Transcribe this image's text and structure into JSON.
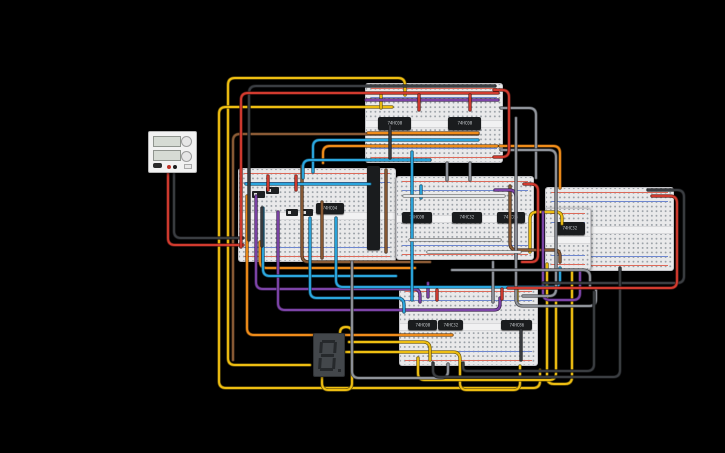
{
  "canvas": {
    "width": 725,
    "height": 453,
    "background": "#000000"
  },
  "wire_colors": {
    "yellow": "#eebe12",
    "red": "#d23b2f",
    "black": "#3a3d41",
    "gray": "#8f939a",
    "white": "#e4e6e8",
    "cyan": "#2ba6de",
    "orange": "#ef8c1a",
    "purple": "#7d44a8",
    "brown": "#8a5a35"
  },
  "power_supply": {
    "x": 148,
    "y": 131,
    "w": 49,
    "h": 42,
    "displays": 2,
    "knobs": 2,
    "terminal_colors": [
      "#c03226",
      "#1c1c1c"
    ]
  },
  "seven_segment": {
    "x": 313,
    "y": 333,
    "w": 32,
    "h": 44,
    "value": "8.",
    "body_color": "#43474b",
    "segment_color": "#26292c"
  },
  "breadboards": [
    {
      "id": "top",
      "x": 365,
      "y": 83,
      "w": 138,
      "h": 80
    },
    {
      "id": "left",
      "x": 238,
      "y": 168,
      "w": 158,
      "h": 94
    },
    {
      "id": "center",
      "x": 396,
      "y": 176,
      "w": 138,
      "h": 84
    },
    {
      "id": "right",
      "x": 545,
      "y": 187,
      "w": 129,
      "h": 84
    },
    {
      "id": "right-mini",
      "x": 545,
      "y": 208,
      "w": 46,
      "h": 62
    },
    {
      "id": "bottom",
      "x": 399,
      "y": 286,
      "w": 139,
      "h": 80
    }
  ],
  "ics": [
    {
      "label": "74HC08",
      "x": 378,
      "y": 117,
      "w": 33,
      "h": 13,
      "vertical": false
    },
    {
      "label": "74HC08",
      "x": 448,
      "y": 117,
      "w": 33,
      "h": 13,
      "vertical": false
    },
    {
      "label": "74HC04",
      "x": 316,
      "y": 203,
      "w": 28,
      "h": 11,
      "vertical": false
    },
    {
      "label": "",
      "x": 367,
      "y": 166,
      "w": 13,
      "h": 84,
      "vertical": true
    },
    {
      "label": "74HC08",
      "x": 402,
      "y": 212,
      "w": 30,
      "h": 11,
      "vertical": false
    },
    {
      "label": "74HC32",
      "x": 452,
      "y": 212,
      "w": 30,
      "h": 11,
      "vertical": false
    },
    {
      "label": "74HC86",
      "x": 497,
      "y": 212,
      "w": 28,
      "h": 11,
      "vertical": false
    },
    {
      "label": "74HC32",
      "x": 555,
      "y": 222,
      "w": 30,
      "h": 13,
      "vertical": false
    },
    {
      "label": "74HC08",
      "x": 408,
      "y": 320,
      "w": 29,
      "h": 10,
      "vertical": false
    },
    {
      "label": "74HC32",
      "x": 438,
      "y": 320,
      "w": 25,
      "h": 10,
      "vertical": false
    },
    {
      "label": "74HC86",
      "x": 501,
      "y": 320,
      "w": 31,
      "h": 10,
      "vertical": false
    }
  ],
  "components": [
    {
      "type": "slide-switch",
      "x": 252,
      "y": 191,
      "w": 13,
      "h": 7
    },
    {
      "type": "slide-switch",
      "x": 266,
      "y": 187,
      "w": 13,
      "h": 7
    },
    {
      "type": "slide-switch",
      "x": 286,
      "y": 209,
      "w": 12,
      "h": 7
    },
    {
      "type": "slide-switch",
      "x": 301,
      "y": 209,
      "w": 12,
      "h": 7
    }
  ],
  "wires": [
    {
      "c": "#eebe12",
      "p": [
        [
          405,
          95
        ],
        [
          405,
          78
        ],
        [
          228,
          78
        ],
        [
          228,
          365
        ],
        [
          310,
          365
        ]
      ]
    },
    {
      "c": "#eebe12",
      "p": [
        [
          392,
          107
        ],
        [
          219,
          107
        ],
        [
          219,
          388
        ],
        [
          540,
          388
        ],
        [
          540,
          370
        ]
      ]
    },
    {
      "c": "#eebe12",
      "p": [
        [
          322,
          374
        ],
        [
          322,
          390
        ],
        [
          352,
          390
        ],
        [
          352,
          327
        ],
        [
          340,
          327
        ],
        [
          340,
          372
        ]
      ]
    },
    {
      "c": "#eebe12",
      "p": [
        [
          346,
          352
        ],
        [
          460,
          352
        ],
        [
          460,
          390
        ],
        [
          520,
          390
        ],
        [
          520,
          366
        ]
      ]
    },
    {
      "c": "#eebe12",
      "p": [
        [
          349,
          342
        ],
        [
          430,
          342
        ],
        [
          430,
          360
        ]
      ]
    },
    {
      "c": "#eebe12",
      "p": [
        [
          530,
          252
        ],
        [
          530,
          212
        ],
        [
          562,
          212
        ],
        [
          562,
          224
        ]
      ]
    },
    {
      "c": "#eebe12",
      "p": [
        [
          547,
          264
        ],
        [
          547,
          384
        ],
        [
          572,
          384
        ],
        [
          572,
          270
        ]
      ]
    },
    {
      "c": "#eebe12",
      "p": [
        [
          418,
          358
        ],
        [
          418,
          380
        ],
        [
          556,
          380
        ],
        [
          556,
          302
        ]
      ]
    },
    {
      "c": "#eebe12",
      "p": [
        [
          381,
          95
        ],
        [
          381,
          108
        ]
      ]
    },
    {
      "c": "#eebe12",
      "p": [
        [
          517,
          290
        ],
        [
          517,
          302
        ]
      ]
    },
    {
      "c": "#8a5a35",
      "p": [
        [
          478,
          134
        ],
        [
          233,
          134
        ],
        [
          233,
          360
        ]
      ]
    },
    {
      "c": "#8a5a35",
      "p": [
        [
          302,
          166
        ],
        [
          302,
          262
        ],
        [
          430,
          262
        ]
      ]
    },
    {
      "c": "#8a5a35",
      "p": [
        [
          322,
          202
        ],
        [
          322,
          258
        ]
      ]
    },
    {
      "c": "#8a5a35",
      "p": [
        [
          510,
          186
        ],
        [
          510,
          250
        ],
        [
          560,
          250
        ],
        [
          560,
          262
        ]
      ]
    },
    {
      "c": "#8a5a35",
      "p": [
        [
          386,
          170
        ],
        [
          386,
          252
        ]
      ]
    },
    {
      "c": "#ef8c1a",
      "p": [
        [
          323,
          163
        ],
        [
          323,
          146
        ],
        [
          497,
          146
        ]
      ]
    },
    {
      "c": "#ef8c1a",
      "p": [
        [
          500,
          146
        ],
        [
          560,
          146
        ],
        [
          560,
          188
        ]
      ]
    },
    {
      "c": "#ef8c1a",
      "p": [
        [
          247,
          196
        ],
        [
          247,
          335
        ],
        [
          452,
          335
        ]
      ]
    },
    {
      "c": "#ef8c1a",
      "p": [
        [
          260,
          242
        ],
        [
          260,
          268
        ],
        [
          415,
          268
        ]
      ]
    },
    {
      "c": "#ef8c1a",
      "p": [
        [
          368,
          133
        ],
        [
          478,
          133
        ]
      ]
    },
    {
      "c": "#7d44a8",
      "p": [
        [
          256,
          196
        ],
        [
          256,
          289
        ],
        [
          420,
          289
        ],
        [
          420,
          302
        ]
      ]
    },
    {
      "c": "#7d44a8",
      "p": [
        [
          278,
          212
        ],
        [
          278,
          310
        ],
        [
          500,
          310
        ],
        [
          500,
          298
        ]
      ]
    },
    {
      "c": "#7d44a8",
      "p": [
        [
          495,
          190
        ],
        [
          516,
          190
        ],
        [
          516,
          258
        ]
      ]
    },
    {
      "c": "#7d44a8",
      "p": [
        [
          543,
          212
        ],
        [
          543,
          300
        ],
        [
          580,
          300
        ],
        [
          580,
          272
        ]
      ]
    },
    {
      "c": "#7d44a8",
      "p": [
        [
          366,
          100
        ],
        [
          498,
          100
        ]
      ]
    },
    {
      "c": "#7d44a8",
      "p": [
        [
          428,
          283
        ],
        [
          428,
          297
        ]
      ]
    },
    {
      "c": "#2ba6de",
      "p": [
        [
          313,
          172
        ],
        [
          313,
          140
        ],
        [
          478,
          140
        ]
      ]
    },
    {
      "c": "#2ba6de",
      "p": [
        [
          303,
          178
        ],
        [
          303,
          160
        ],
        [
          430,
          160
        ]
      ]
    },
    {
      "c": "#2ba6de",
      "p": [
        [
          246,
          184
        ],
        [
          370,
          184
        ]
      ]
    },
    {
      "c": "#2ba6de",
      "p": [
        [
          263,
          208
        ],
        [
          263,
          276
        ],
        [
          396,
          276
        ]
      ]
    },
    {
      "c": "#2ba6de",
      "p": [
        [
          310,
          218
        ],
        [
          310,
          298
        ],
        [
          404,
          298
        ],
        [
          404,
          312
        ]
      ]
    },
    {
      "c": "#2ba6de",
      "p": [
        [
          336,
          218
        ],
        [
          336,
          287
        ],
        [
          560,
          287
        ],
        [
          560,
          268
        ]
      ]
    },
    {
      "c": "#2ba6de",
      "p": [
        [
          412,
          152
        ],
        [
          412,
          300
        ]
      ]
    },
    {
      "c": "#2ba6de",
      "p": [
        [
          421,
          186
        ],
        [
          421,
          198
        ]
      ]
    },
    {
      "c": "#8f939a",
      "p": [
        [
          501,
          108
        ],
        [
          536,
          108
        ],
        [
          536,
          178
        ]
      ]
    },
    {
      "c": "#8f939a",
      "p": [
        [
          501,
          150
        ],
        [
          556,
          150
        ],
        [
          556,
          296
        ],
        [
          523,
          296
        ]
      ]
    },
    {
      "c": "#8f939a",
      "p": [
        [
          447,
          163
        ],
        [
          447,
          180
        ]
      ]
    },
    {
      "c": "#8f939a",
      "p": [
        [
          470,
          163
        ],
        [
          470,
          180
        ]
      ]
    },
    {
      "c": "#8f939a",
      "p": [
        [
          516,
          118
        ],
        [
          516,
          306
        ],
        [
          596,
          306
        ],
        [
          596,
          290
        ]
      ]
    },
    {
      "c": "#8f939a",
      "p": [
        [
          352,
          262
        ],
        [
          352,
          378
        ],
        [
          448,
          378
        ],
        [
          448,
          364
        ]
      ]
    },
    {
      "c": "#8f939a",
      "p": [
        [
          493,
          262
        ],
        [
          493,
          302
        ]
      ]
    },
    {
      "c": "#8f939a",
      "p": [
        [
          452,
          270
        ],
        [
          590,
          270
        ],
        [
          590,
          286
        ]
      ]
    },
    {
      "c": "#e4e6e8",
      "p": [
        [
          404,
          196
        ],
        [
          504,
          196
        ]
      ]
    },
    {
      "c": "#e4e6e8",
      "p": [
        [
          410,
          240
        ],
        [
          500,
          240
        ]
      ]
    },
    {
      "c": "#e4e6e8",
      "p": [
        [
          428,
          252
        ],
        [
          520,
          252
        ]
      ]
    },
    {
      "c": "#3a3d41",
      "p": [
        [
          174,
          172
        ],
        [
          174,
          238
        ],
        [
          243,
          238
        ]
      ]
    },
    {
      "c": "#3a3d41",
      "p": [
        [
          495,
          86
        ],
        [
          249,
          86
        ],
        [
          249,
          240
        ]
      ]
    },
    {
      "c": "#3a3d41",
      "p": [
        [
          648,
          190
        ],
        [
          684,
          190
        ],
        [
          684,
          283
        ],
        [
          543,
          283
        ]
      ]
    },
    {
      "c": "#3a3d41",
      "p": [
        [
          433,
          363
        ],
        [
          433,
          377
        ],
        [
          620,
          377
        ],
        [
          620,
          268
        ]
      ]
    },
    {
      "c": "#3a3d41",
      "p": [
        [
          463,
          363
        ],
        [
          463,
          371
        ],
        [
          594,
          371
        ],
        [
          594,
          292
        ]
      ]
    },
    {
      "c": "#3a3d41",
      "p": [
        [
          262,
          208
        ],
        [
          262,
          246
        ]
      ]
    },
    {
      "c": "#3a3d41",
      "p": [
        [
          390,
          126
        ],
        [
          390,
          158
        ]
      ]
    },
    {
      "c": "#3a3d41",
      "p": [
        [
          521,
          330
        ],
        [
          521,
          360
        ]
      ]
    },
    {
      "c": "#d23b2f",
      "p": [
        [
          168,
          172
        ],
        [
          168,
          245
        ],
        [
          243,
          245
        ]
      ]
    },
    {
      "c": "#d23b2f",
      "p": [
        [
          498,
          93
        ],
        [
          241,
          93
        ],
        [
          241,
          247
        ]
      ]
    },
    {
      "c": "#d23b2f",
      "p": [
        [
          494,
          90
        ],
        [
          509,
          90
        ],
        [
          509,
          157
        ],
        [
          494,
          157
        ]
      ]
    },
    {
      "c": "#d23b2f",
      "p": [
        [
          652,
          196
        ],
        [
          677,
          196
        ],
        [
          677,
          288
        ],
        [
          508,
          288
        ]
      ]
    },
    {
      "c": "#d23b2f",
      "p": [
        [
          524,
          184
        ],
        [
          538,
          184
        ],
        [
          538,
          262
        ],
        [
          522,
          262
        ]
      ]
    },
    {
      "c": "#d23b2f",
      "p": [
        [
          268,
          176
        ],
        [
          268,
          190
        ]
      ]
    },
    {
      "c": "#d23b2f",
      "p": [
        [
          296,
          176
        ],
        [
          296,
          190
        ]
      ]
    },
    {
      "c": "#d23b2f",
      "p": [
        [
          437,
          290
        ],
        [
          437,
          300
        ]
      ]
    },
    {
      "c": "#d23b2f",
      "p": [
        [
          502,
          289
        ],
        [
          502,
          299
        ]
      ]
    },
    {
      "c": "#d23b2f",
      "p": [
        [
          419,
          95
        ],
        [
          419,
          110
        ]
      ]
    },
    {
      "c": "#d23b2f",
      "p": [
        [
          470,
          95
        ],
        [
          470,
          110
        ]
      ]
    }
  ]
}
